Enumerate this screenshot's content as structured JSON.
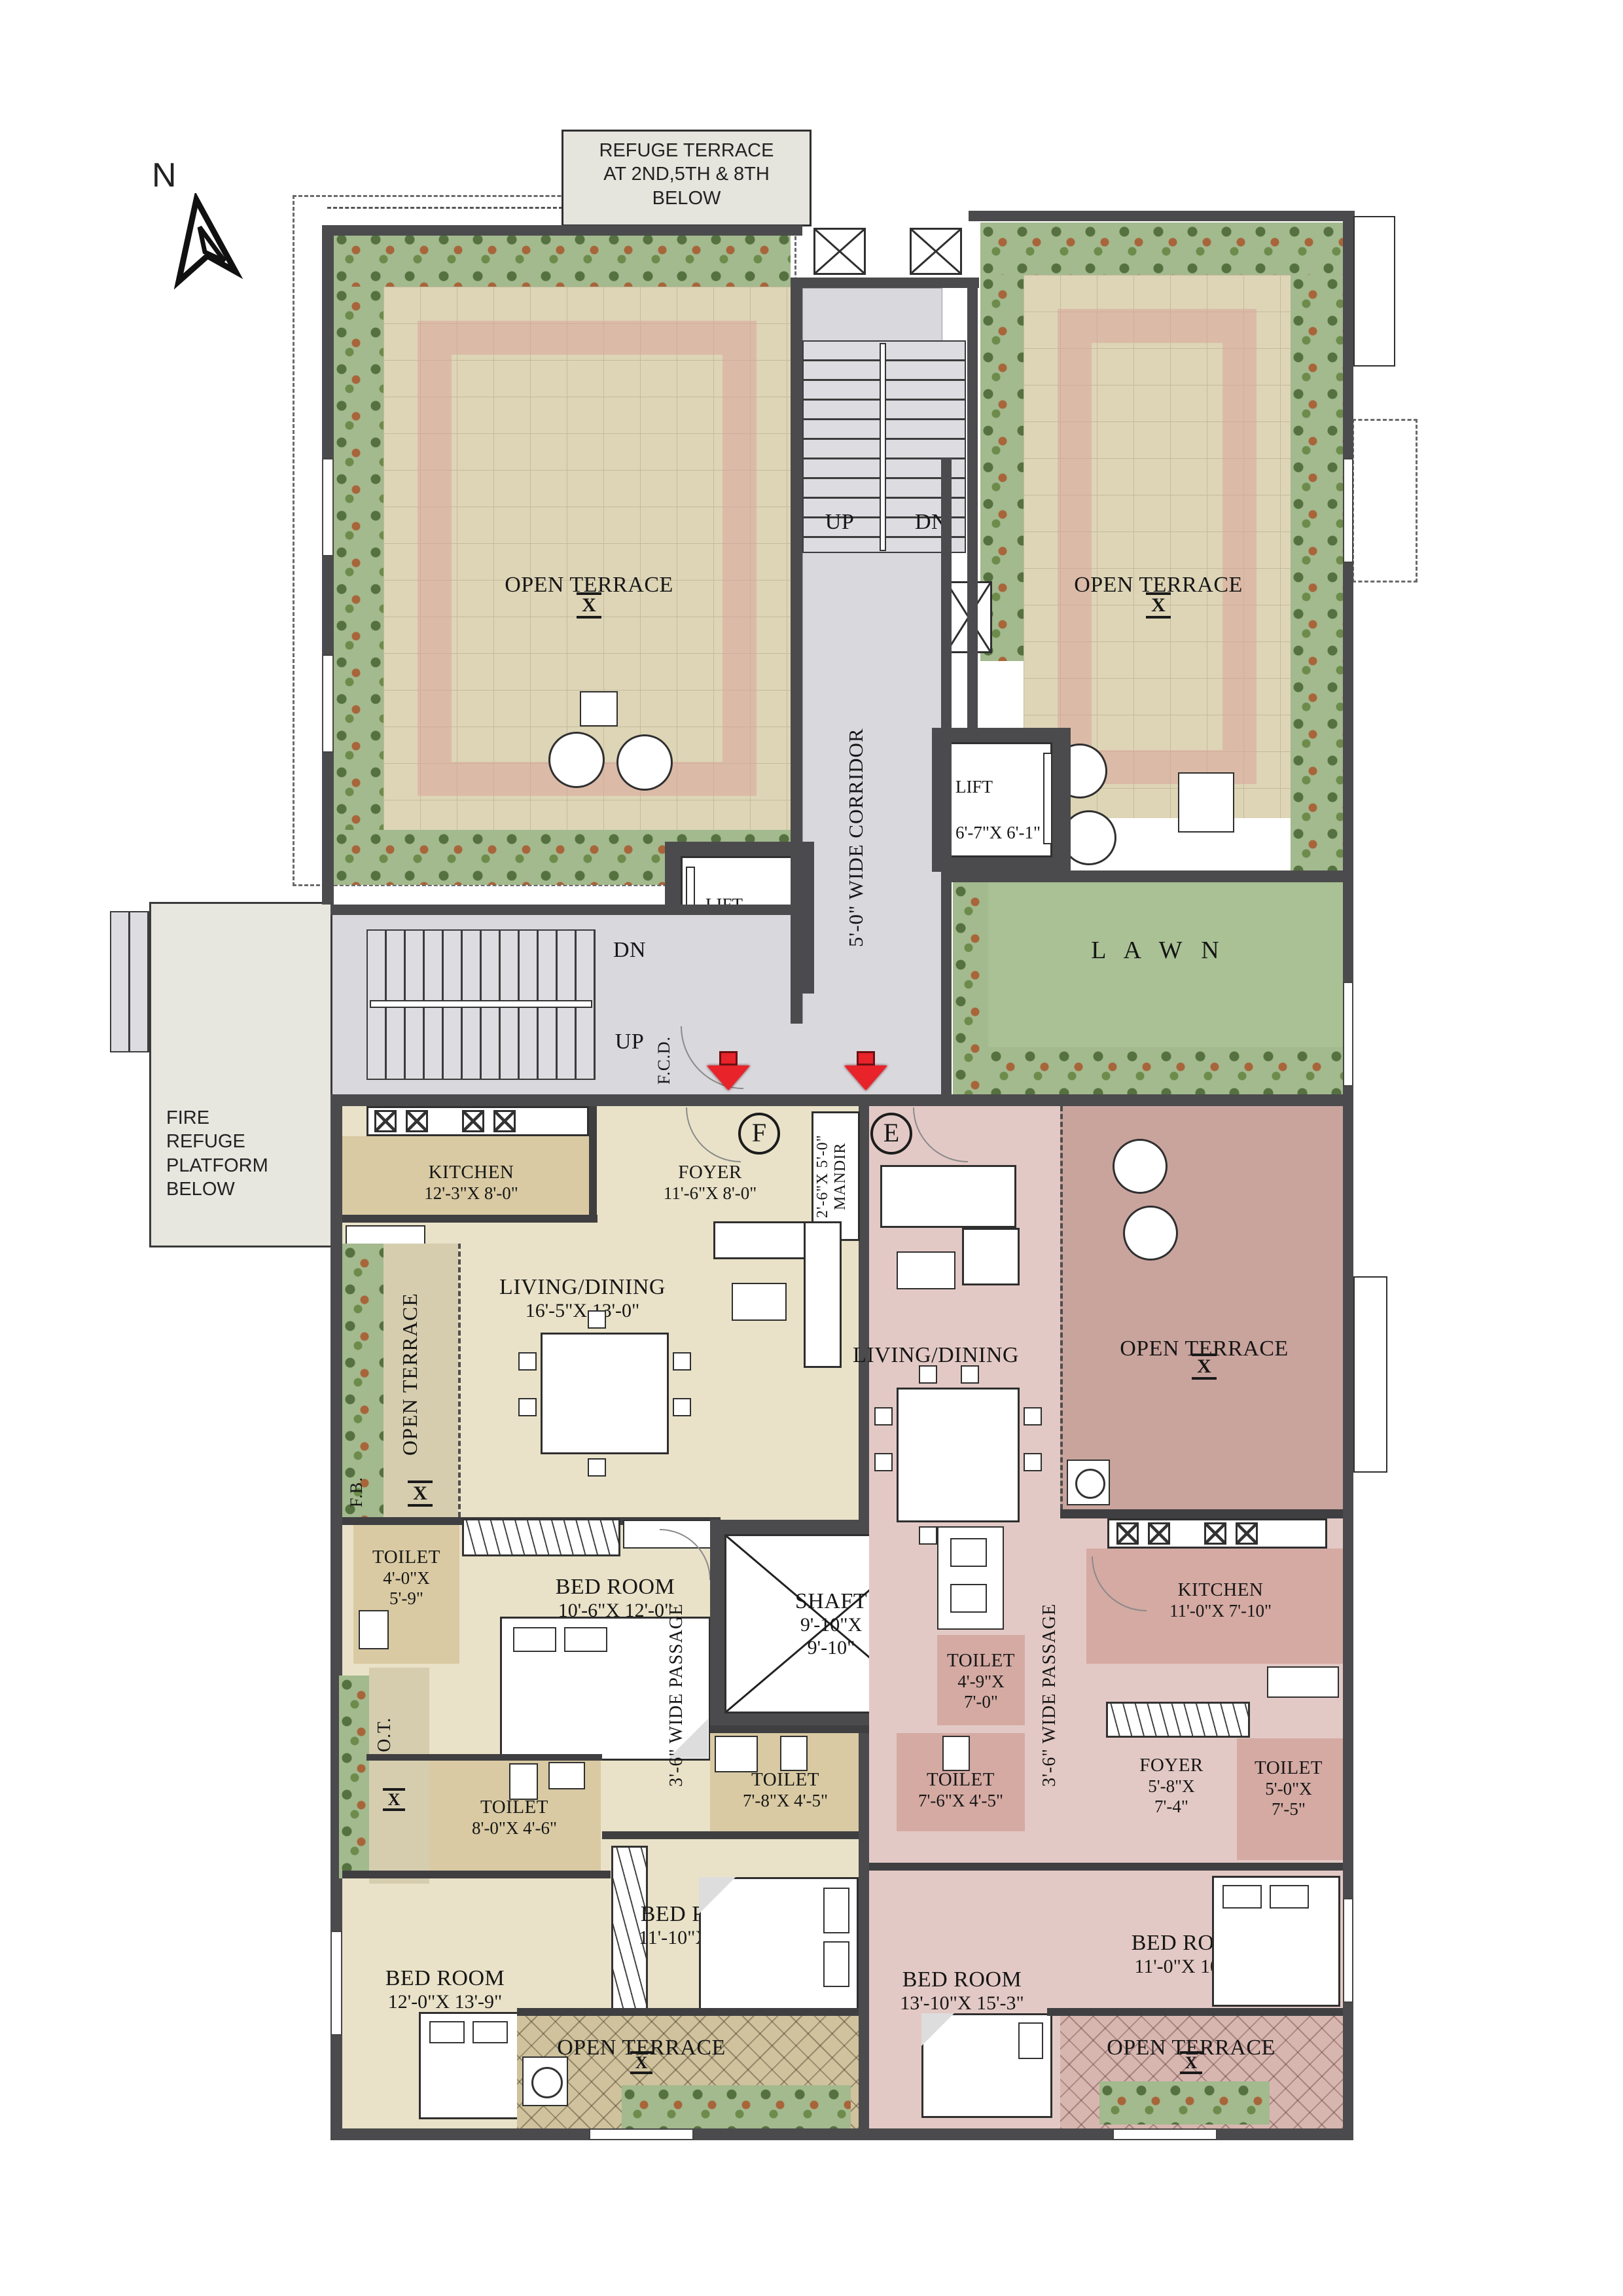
{
  "colors": {
    "wall": "#4b4b4d",
    "unit_f_fill": "#e9e2c8",
    "unit_e_fill": "#e3c9c5",
    "terrace_tile": "#ddd5b6",
    "terrace_pink_band": "#d9a59b",
    "lawn_green": "#a9c194",
    "planter_green": "#a3b98e",
    "corridor_gray": "#d8d8dd",
    "entry_arrow_red": "#e8232a"
  },
  "compass": {
    "label": "N"
  },
  "notes": {
    "refuge_terrace": "REFUGE TERRACE\nAT 2ND,5TH & 8TH\nBELOW",
    "fire_refuge": "FIRE\nREFUGE\nPLATFORM\nBELOW"
  },
  "common": {
    "open_terrace": "OPEN TERRACE",
    "terrace_sym": "X",
    "ot_abbr": "O.T.",
    "fb_abbr": "F.B.",
    "up": "UP",
    "dn": "DN",
    "fcd": "F.C.D.",
    "lawn": "L A W N",
    "corridor": "5'-0\" WIDE CORRIDOR",
    "mandir": "2'-6\"X 5'-0\"\nMANDIR"
  },
  "lift": {
    "name": "LIFT",
    "dims": "6'-7\"X 6'-1\"",
    "pax": "10 PAX."
  },
  "shaft": {
    "name": "SHAFT",
    "dims": "9'-10\"X\n9'-10\""
  },
  "unit_f": {
    "marker": "F",
    "kitchen": {
      "name": "KITCHEN",
      "dims": "12'-3\"X 8'-0\""
    },
    "foyer": {
      "name": "FOYER",
      "dims": "11'-6\"X 8'-0\""
    },
    "living": {
      "name": "LIVING/DINING",
      "dims": "16'-5\"X 13'-0\""
    },
    "passage": "3'-6\" WIDE PASSAGE",
    "toilet_a": {
      "name": "TOILET",
      "dims": "4'-0\"X\n5'-9\""
    },
    "toilet_b": {
      "name": "TOILET",
      "dims": "8'-0\"X 4'-6\""
    },
    "toilet_c": {
      "name": "TOILET",
      "dims": "7'-8\"X 4'-5\""
    },
    "bed_a": {
      "name": "BED ROOM",
      "dims": "10'-6\"X 12'-0\""
    },
    "bed_b": {
      "name": "BED ROOM",
      "dims": "11'-10\"X 10'-0\""
    },
    "bed_c": {
      "name": "BED ROOM",
      "dims": "12'-0\"X 13'-9\""
    }
  },
  "unit_e": {
    "marker": "E",
    "kitchen": {
      "name": "KITCHEN",
      "dims": "11'-0\"X 7'-10\""
    },
    "foyer": {
      "name": "FOYER",
      "dims": "5'-8\"X\n7'-4\""
    },
    "living": {
      "name": "LIVING/DINING",
      "dims": ""
    },
    "passage": "3'-6\" WIDE PASSAGE",
    "toilet_a": {
      "name": "TOILET",
      "dims": "4'-9\"X\n7'-0\""
    },
    "toilet_b": {
      "name": "TOILET",
      "dims": "7'-6\"X 4'-5\""
    },
    "toilet_c": {
      "name": "TOILET",
      "dims": "5'-0\"X\n7'-5\""
    },
    "bed_a": {
      "name": "BED ROOM",
      "dims": "13'-10\"X 15'-3\""
    },
    "bed_b": {
      "name": "BED ROOM",
      "dims": "11'-0\"X 10'-0\""
    }
  }
}
